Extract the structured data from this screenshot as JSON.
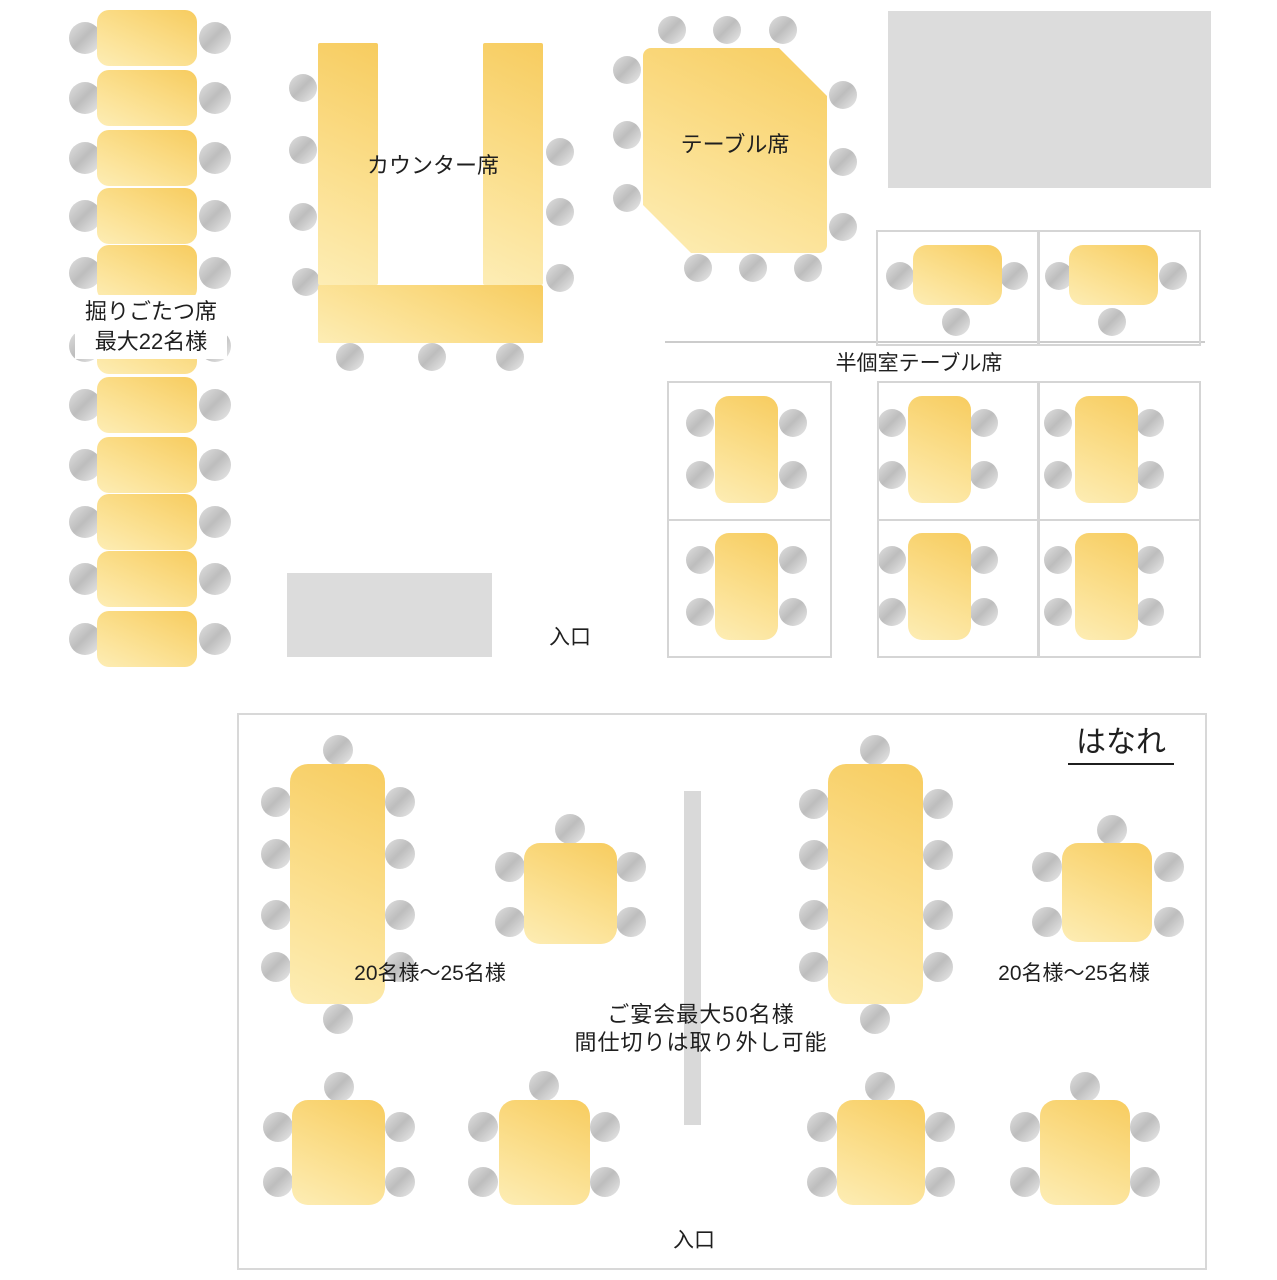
{
  "title": "restaurant-floor-plan",
  "labels": {
    "horigotatsu_line1": "掘りごたつ席",
    "horigotatsu_line2": "最大22名様",
    "counter": "カウンター席",
    "table_seats": "テーブル席",
    "semi_private": "半個室テーブル席",
    "entrance_main": "入口",
    "hanare": "はなれ",
    "capacity_left": "20名様〜25名様",
    "capacity_right": "20名様〜25名様",
    "banquet_line1": "ご宴会最大50名様",
    "banquet_line2": "間仕切りは取り外し可能",
    "entrance_hanare": "入口"
  },
  "colors": {
    "table_gradient_dark": "#f7cc5f",
    "table_gradient_light": "#fdedb5",
    "chair_dark": "#bdbdbd",
    "chair_light": "#ebebeb",
    "wall_gray": "#dcdcdc",
    "cell_border": "#d5d5d5",
    "room_border": "#d8d8d8",
    "partition_gray": "#d9d9d9",
    "text": "#1f1f1f",
    "background": "#ffffff"
  },
  "floorplan": {
    "canvas": {
      "w": 1277,
      "h": 1280
    },
    "walls": [
      {
        "name": "wall-block-top-right",
        "x": 888,
        "y": 11,
        "w": 323,
        "h": 177
      },
      {
        "name": "wall-block-entrance",
        "x": 287,
        "y": 573,
        "w": 205,
        "h": 84
      }
    ],
    "room": {
      "name": "hanare-room-outline",
      "x": 237,
      "y": 713,
      "w": 966,
      "h": 553
    },
    "divider": {
      "name": "semi-private-divider-line",
      "x": 665,
      "y": 341,
      "w": 540,
      "h": 2
    },
    "partition": {
      "name": "removable-partition-bar",
      "x": 684,
      "y": 791,
      "w": 17,
      "h": 334
    },
    "cells": [
      {
        "name": "semi-private-cell",
        "x": 876,
        "y": 230,
        "w": 159,
        "h": 112
      },
      {
        "name": "semi-private-cell",
        "x": 1038,
        "y": 230,
        "w": 159,
        "h": 112
      },
      {
        "name": "semi-private-cell",
        "x": 667,
        "y": 381,
        "w": 161,
        "h": 136
      },
      {
        "name": "semi-private-cell",
        "x": 667,
        "y": 519,
        "w": 161,
        "h": 135
      },
      {
        "name": "semi-private-cell",
        "x": 877,
        "y": 381,
        "w": 158,
        "h": 136
      },
      {
        "name": "semi-private-cell",
        "x": 877,
        "y": 519,
        "w": 158,
        "h": 135
      },
      {
        "name": "semi-private-cell",
        "x": 1038,
        "y": 381,
        "w": 159,
        "h": 136
      },
      {
        "name": "semi-private-cell",
        "x": 1038,
        "y": 519,
        "w": 159,
        "h": 135
      }
    ],
    "counter_bars": [
      {
        "name": "counter-bar-left",
        "x": 318,
        "y": 43,
        "w": 60,
        "h": 242
      },
      {
        "name": "counter-bar-right",
        "x": 483,
        "y": 43,
        "w": 60,
        "h": 242
      },
      {
        "name": "counter-bar-bottom",
        "x": 318,
        "y": 285,
        "w": 225,
        "h": 58
      }
    ],
    "tables": [
      {
        "name": "horigotatsu-table",
        "x": 97,
        "y": 10,
        "w": 100,
        "h": 56,
        "rad": 12
      },
      {
        "name": "horigotatsu-table",
        "x": 97,
        "y": 70,
        "w": 100,
        "h": 56,
        "rad": 12
      },
      {
        "name": "horigotatsu-table",
        "x": 97,
        "y": 130,
        "w": 100,
        "h": 56,
        "rad": 12
      },
      {
        "name": "horigotatsu-table",
        "x": 97,
        "y": 188,
        "w": 100,
        "h": 56,
        "rad": 12
      },
      {
        "name": "horigotatsu-table",
        "x": 97,
        "y": 245,
        "w": 100,
        "h": 56,
        "rad": 12
      },
      {
        "name": "horigotatsu-table",
        "x": 97,
        "y": 318,
        "w": 100,
        "h": 56,
        "rad": 12
      },
      {
        "name": "horigotatsu-table",
        "x": 97,
        "y": 377,
        "w": 100,
        "h": 56,
        "rad": 12
      },
      {
        "name": "horigotatsu-table",
        "x": 97,
        "y": 437,
        "w": 100,
        "h": 56,
        "rad": 12
      },
      {
        "name": "horigotatsu-table",
        "x": 97,
        "y": 494,
        "w": 100,
        "h": 56,
        "rad": 12
      },
      {
        "name": "horigotatsu-table",
        "x": 97,
        "y": 551,
        "w": 100,
        "h": 56,
        "rad": 12
      },
      {
        "name": "horigotatsu-table",
        "x": 97,
        "y": 611,
        "w": 100,
        "h": 56,
        "rad": 12
      },
      {
        "name": "table-seats-table",
        "x": 643,
        "y": 48,
        "w": 184,
        "h": 205,
        "rad": 8,
        "clip": "polygon(0px 0px, 136px 0px, 184px 48px, 184px 205px, 48px 205px, 0px 157px)"
      },
      {
        "name": "semi-private-table",
        "x": 913,
        "y": 245,
        "w": 89,
        "h": 60,
        "rad": 14
      },
      {
        "name": "semi-private-table",
        "x": 1069,
        "y": 245,
        "w": 89,
        "h": 60,
        "rad": 14
      },
      {
        "name": "semi-private-table",
        "x": 715,
        "y": 396,
        "w": 63,
        "h": 107,
        "rad": 14
      },
      {
        "name": "semi-private-table",
        "x": 715,
        "y": 533,
        "w": 63,
        "h": 107,
        "rad": 14
      },
      {
        "name": "semi-private-table",
        "x": 908,
        "y": 396,
        "w": 63,
        "h": 107,
        "rad": 14
      },
      {
        "name": "semi-private-table",
        "x": 908,
        "y": 533,
        "w": 63,
        "h": 107,
        "rad": 14
      },
      {
        "name": "semi-private-table",
        "x": 1075,
        "y": 396,
        "w": 63,
        "h": 107,
        "rad": 14
      },
      {
        "name": "semi-private-table",
        "x": 1075,
        "y": 533,
        "w": 63,
        "h": 107,
        "rad": 14
      },
      {
        "name": "hanare-long-table",
        "x": 290,
        "y": 764,
        "w": 95,
        "h": 240,
        "rad": 18
      },
      {
        "name": "hanare-long-table",
        "x": 828,
        "y": 764,
        "w": 95,
        "h": 240,
        "rad": 18
      },
      {
        "name": "hanare-square-table",
        "x": 524,
        "y": 843,
        "w": 93,
        "h": 101,
        "rad": 16
      },
      {
        "name": "hanare-square-table",
        "x": 1062,
        "y": 843,
        "w": 90,
        "h": 99,
        "rad": 16
      },
      {
        "name": "hanare-square-table",
        "x": 292,
        "y": 1100,
        "w": 93,
        "h": 105,
        "rad": 16
      },
      {
        "name": "hanare-square-table",
        "x": 499,
        "y": 1100,
        "w": 91,
        "h": 105,
        "rad": 16
      },
      {
        "name": "hanare-square-table",
        "x": 837,
        "y": 1100,
        "w": 88,
        "h": 105,
        "rad": 16
      },
      {
        "name": "hanare-square-table",
        "x": 1040,
        "y": 1100,
        "w": 90,
        "h": 105,
        "rad": 16
      }
    ],
    "chair_groups": [
      {
        "name": "horigotatsu-chair",
        "r": 16,
        "pts": [
          [
            85,
            38
          ],
          [
            215,
            38
          ],
          [
            85,
            98
          ],
          [
            215,
            98
          ],
          [
            85,
            158
          ],
          [
            215,
            158
          ],
          [
            85,
            216
          ],
          [
            215,
            216
          ],
          [
            85,
            273
          ],
          [
            215,
            273
          ],
          [
            85,
            346
          ],
          [
            215,
            346
          ],
          [
            85,
            405
          ],
          [
            215,
            405
          ],
          [
            85,
            465
          ],
          [
            215,
            465
          ],
          [
            85,
            522
          ],
          [
            215,
            522
          ],
          [
            85,
            579
          ],
          [
            215,
            579
          ],
          [
            85,
            639
          ],
          [
            215,
            639
          ]
        ]
      },
      {
        "name": "counter-chair",
        "r": 14,
        "pts": [
          [
            303,
            88
          ],
          [
            303,
            150
          ],
          [
            303,
            217
          ],
          [
            306,
            282
          ],
          [
            350,
            357
          ],
          [
            432,
            357
          ],
          [
            510,
            357
          ],
          [
            560,
            152
          ],
          [
            560,
            212
          ],
          [
            560,
            278
          ]
        ]
      },
      {
        "name": "table-seats-chair",
        "r": 14,
        "pts": [
          [
            672,
            30
          ],
          [
            727,
            30
          ],
          [
            783,
            30
          ],
          [
            627,
            70
          ],
          [
            627,
            135
          ],
          [
            627,
            198
          ],
          [
            843,
            95
          ],
          [
            843,
            162
          ],
          [
            843,
            227
          ],
          [
            698,
            268
          ],
          [
            753,
            268
          ],
          [
            808,
            268
          ]
        ]
      },
      {
        "name": "semi-private-chair",
        "r": 14,
        "pts": [
          [
            900,
            276
          ],
          [
            1014,
            276
          ],
          [
            956,
            322
          ],
          [
            1059,
            276
          ],
          [
            1173,
            276
          ],
          [
            1112,
            322
          ],
          [
            700,
            423
          ],
          [
            700,
            475
          ],
          [
            793,
            423
          ],
          [
            793,
            475
          ],
          [
            700,
            560
          ],
          [
            700,
            612
          ],
          [
            793,
            560
          ],
          [
            793,
            612
          ],
          [
            892,
            423
          ],
          [
            892,
            475
          ],
          [
            984,
            423
          ],
          [
            984,
            475
          ],
          [
            892,
            560
          ],
          [
            892,
            612
          ],
          [
            984,
            560
          ],
          [
            984,
            612
          ],
          [
            1058,
            423
          ],
          [
            1058,
            475
          ],
          [
            1150,
            423
          ],
          [
            1150,
            475
          ],
          [
            1058,
            560
          ],
          [
            1058,
            612
          ],
          [
            1150,
            560
          ],
          [
            1150,
            612
          ]
        ]
      },
      {
        "name": "hanare-chair",
        "r": 15,
        "pts": [
          [
            338,
            750
          ],
          [
            338,
            1019
          ],
          [
            276,
            802
          ],
          [
            276,
            854
          ],
          [
            276,
            915
          ],
          [
            276,
            967
          ],
          [
            400,
            802
          ],
          [
            400,
            854
          ],
          [
            400,
            915
          ],
          [
            400,
            967
          ],
          [
            570,
            829
          ],
          [
            510,
            867
          ],
          [
            510,
            922
          ],
          [
            631,
            867
          ],
          [
            631,
            922
          ],
          [
            875,
            750
          ],
          [
            875,
            1019
          ],
          [
            814,
            804
          ],
          [
            814,
            855
          ],
          [
            814,
            915
          ],
          [
            814,
            967
          ],
          [
            938,
            804
          ],
          [
            938,
            855
          ],
          [
            938,
            915
          ],
          [
            938,
            967
          ],
          [
            1112,
            830
          ],
          [
            1047,
            867
          ],
          [
            1047,
            922
          ],
          [
            1169,
            867
          ],
          [
            1169,
            922
          ],
          [
            339,
            1087
          ],
          [
            278,
            1127
          ],
          [
            278,
            1182
          ],
          [
            400,
            1127
          ],
          [
            400,
            1182
          ],
          [
            544,
            1086
          ],
          [
            483,
            1127
          ],
          [
            483,
            1182
          ],
          [
            605,
            1127
          ],
          [
            605,
            1182
          ],
          [
            880,
            1087
          ],
          [
            822,
            1127
          ],
          [
            822,
            1182
          ],
          [
            940,
            1127
          ],
          [
            940,
            1182
          ],
          [
            1085,
            1087
          ],
          [
            1025,
            1127
          ],
          [
            1025,
            1182
          ],
          [
            1145,
            1127
          ],
          [
            1145,
            1182
          ]
        ]
      }
    ]
  }
}
